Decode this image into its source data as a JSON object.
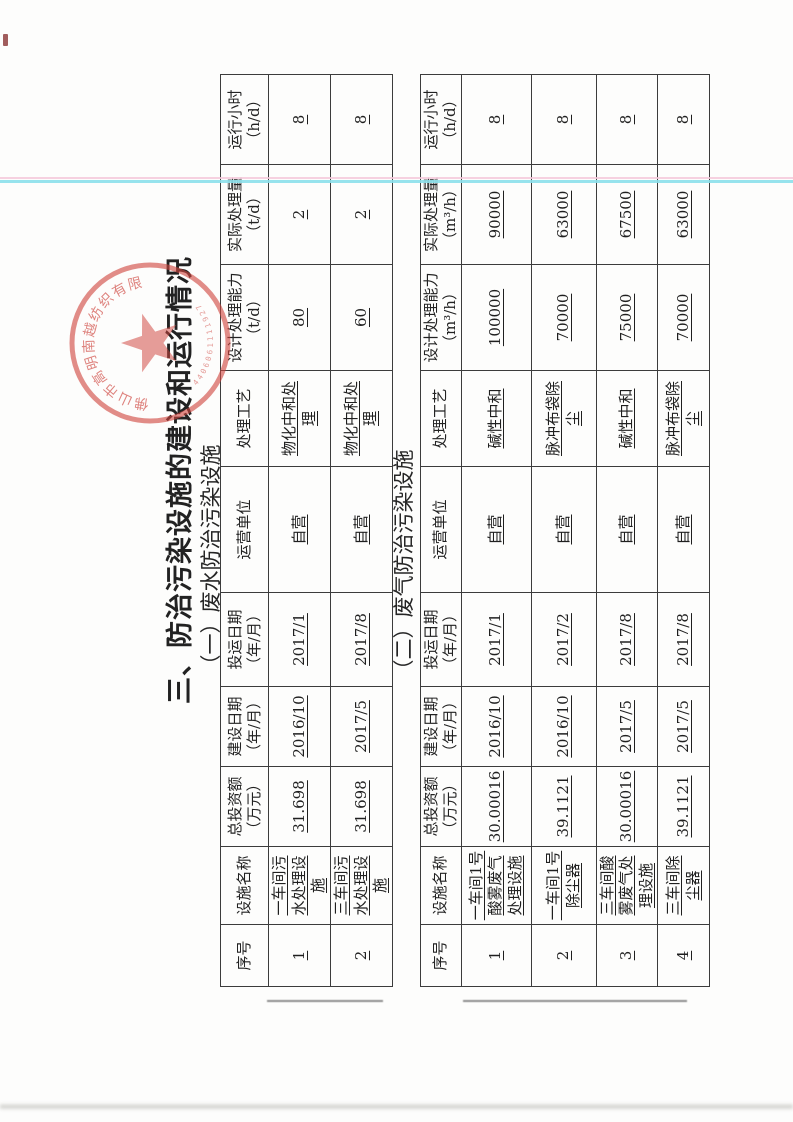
{
  "page": {
    "title": "三、防治污染设施的建设和运行情况",
    "section1_title": "（一）废水防治污染设施",
    "section2_title": "（二）废气防治污染设施"
  },
  "stamp": {
    "arc_text": "佛山市高明南越纺织有限公司",
    "serial_digits": "4406061111927",
    "color": "#cf4a44"
  },
  "artifact_colors": {
    "scanline_pink": "#f4c9da",
    "scanline_cyan": "#8ce0eb",
    "fold_line_gray": "#6a6a6a"
  },
  "tables": [
    {
      "name": "废水防治污染设施表",
      "headers": [
        "序号",
        "设施名称",
        "总投资额（万元）",
        "建设日期（年/月）",
        "投运日期（年/月）",
        "运营单位",
        "处理工艺",
        "设计处理能力（t/d）",
        "实际处理量（t/d）",
        "运行小时（h/d）"
      ],
      "rows": [
        [
          "1",
          "一车间污水处理设施",
          "31.698",
          "2016/10",
          "2017/1",
          "自营",
          "物化中和处理",
          "80",
          "2",
          "8"
        ],
        [
          "2",
          "三车间污水处理设施",
          "31.698",
          "2017/5",
          "2017/8",
          "自营",
          "物化中和处理",
          "60",
          "2",
          "8"
        ]
      ]
    },
    {
      "name": "废气防治污染设施表",
      "headers": [
        "序号",
        "设施名称",
        "总投资额（万元）",
        "建设日期（年/月）",
        "投运日期（年/月）",
        "运营单位",
        "处理工艺",
        "设计处理能力（m³/h）",
        "实际处理量（m³/h）",
        "运行小时（h/d）"
      ],
      "rows": [
        [
          "1",
          "一车间1号酸雾废气处理设施",
          "30.00016",
          "2016/10",
          "2017/1",
          "自营",
          "碱性中和",
          "100000",
          "90000",
          "8"
        ],
        [
          "2",
          "一车间1号除尘器",
          "39.1121",
          "2016/10",
          "2017/2",
          "自营",
          "脉冲布袋除尘",
          "70000",
          "63000",
          "8"
        ],
        [
          "3",
          "三车间酸雾废气处理设施",
          "30.00016",
          "2017/5",
          "2017/8",
          "自营",
          "碱性中和",
          "75000",
          "67500",
          "8"
        ],
        [
          "4",
          "三车间除尘器",
          "39.1121",
          "2017/5",
          "2017/8",
          "自营",
          "脉冲布袋除尘",
          "70000",
          "63000",
          "8"
        ]
      ]
    }
  ]
}
